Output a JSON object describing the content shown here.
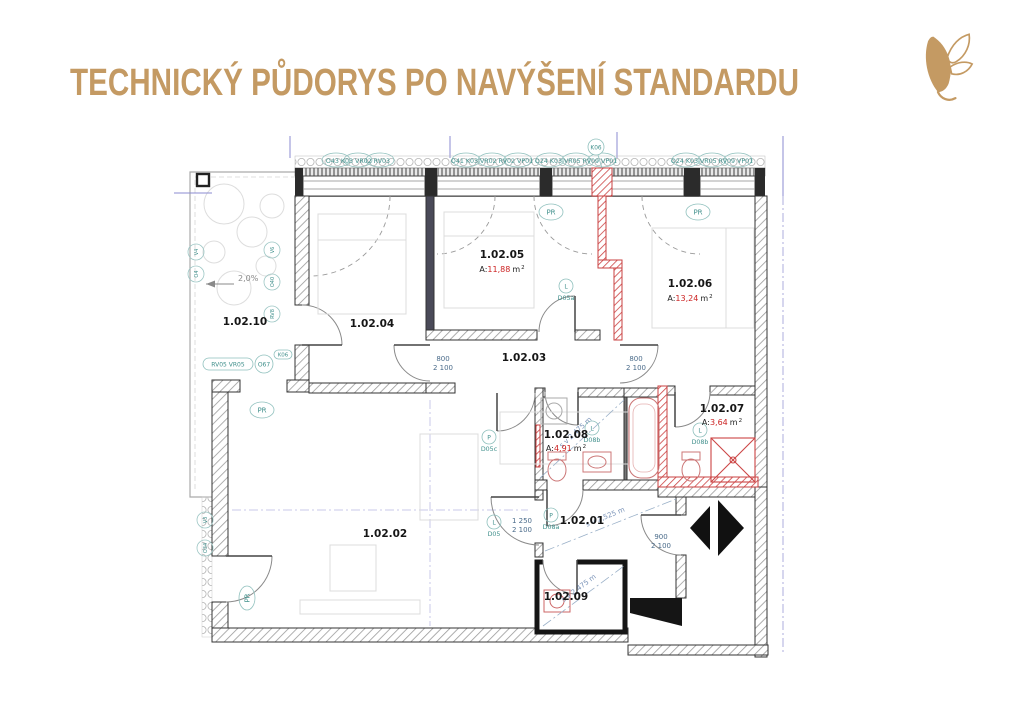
{
  "slide": {
    "title": "TECHNICKÝ PŮDORYS PO NAVÝŠENÍ STANDARDU"
  },
  "plan": {
    "rooms": [
      {
        "id": "1.02.01"
      },
      {
        "id": "1.02.02"
      },
      {
        "id": "1.02.03"
      },
      {
        "id": "1.02.04"
      },
      {
        "id": "1.02.05",
        "area_prefix": "A:",
        "area_value": "11,88",
        "area_unit": "m",
        "area_sup": "2"
      },
      {
        "id": "1.02.06",
        "area_prefix": "A:",
        "area_value": "13,24",
        "area_unit": "m",
        "area_sup": "2"
      },
      {
        "id": "1.02.07",
        "area_prefix": "A:",
        "area_value": "3,64",
        "area_unit": "m",
        "area_sup": "2"
      },
      {
        "id": "1.02.08",
        "area_prefix": "A:",
        "area_value": "4,91",
        "area_unit": "m",
        "area_sup": "2"
      },
      {
        "id": "1.02.09"
      },
      {
        "id": "1.02.10"
      }
    ],
    "window_labels": [
      "O43 K03 VR02 RV03",
      "O41 K03 VR02 RV02 VP01",
      "O24 K03 VR05 RV09 VP01",
      "O24 K03 VR05 RV09 VP01"
    ],
    "markers": {
      "k06": "K06",
      "pr": "PR",
      "o67": "O67",
      "rv05": "RV05 VR05",
      "slope": "2,0%"
    },
    "door_labels": [
      {
        "letter": "L",
        "code": "D05a"
      },
      {
        "letter": "P",
        "code": "D05c"
      },
      {
        "letter": "L",
        "code": "D05"
      },
      {
        "letter": "P",
        "code": "D08a"
      },
      {
        "letter": "L",
        "code": "D08b"
      },
      {
        "letter": "L",
        "code": "D08b"
      }
    ],
    "dims": [
      {
        "w": "800",
        "h": "2 100"
      },
      {
        "w": "800",
        "h": "2 100"
      },
      {
        "w": "1 250",
        "h": "2 100"
      },
      {
        "w": "900",
        "h": "2 100"
      }
    ],
    "diagonals": [
      "s v 2,475 m",
      "s v 2,525 m",
      "s v 2,475 m"
    ],
    "edge_codes": [
      "V6",
      "O40",
      "RV8",
      "V4",
      "O4",
      "V3",
      "O34"
    ]
  }
}
